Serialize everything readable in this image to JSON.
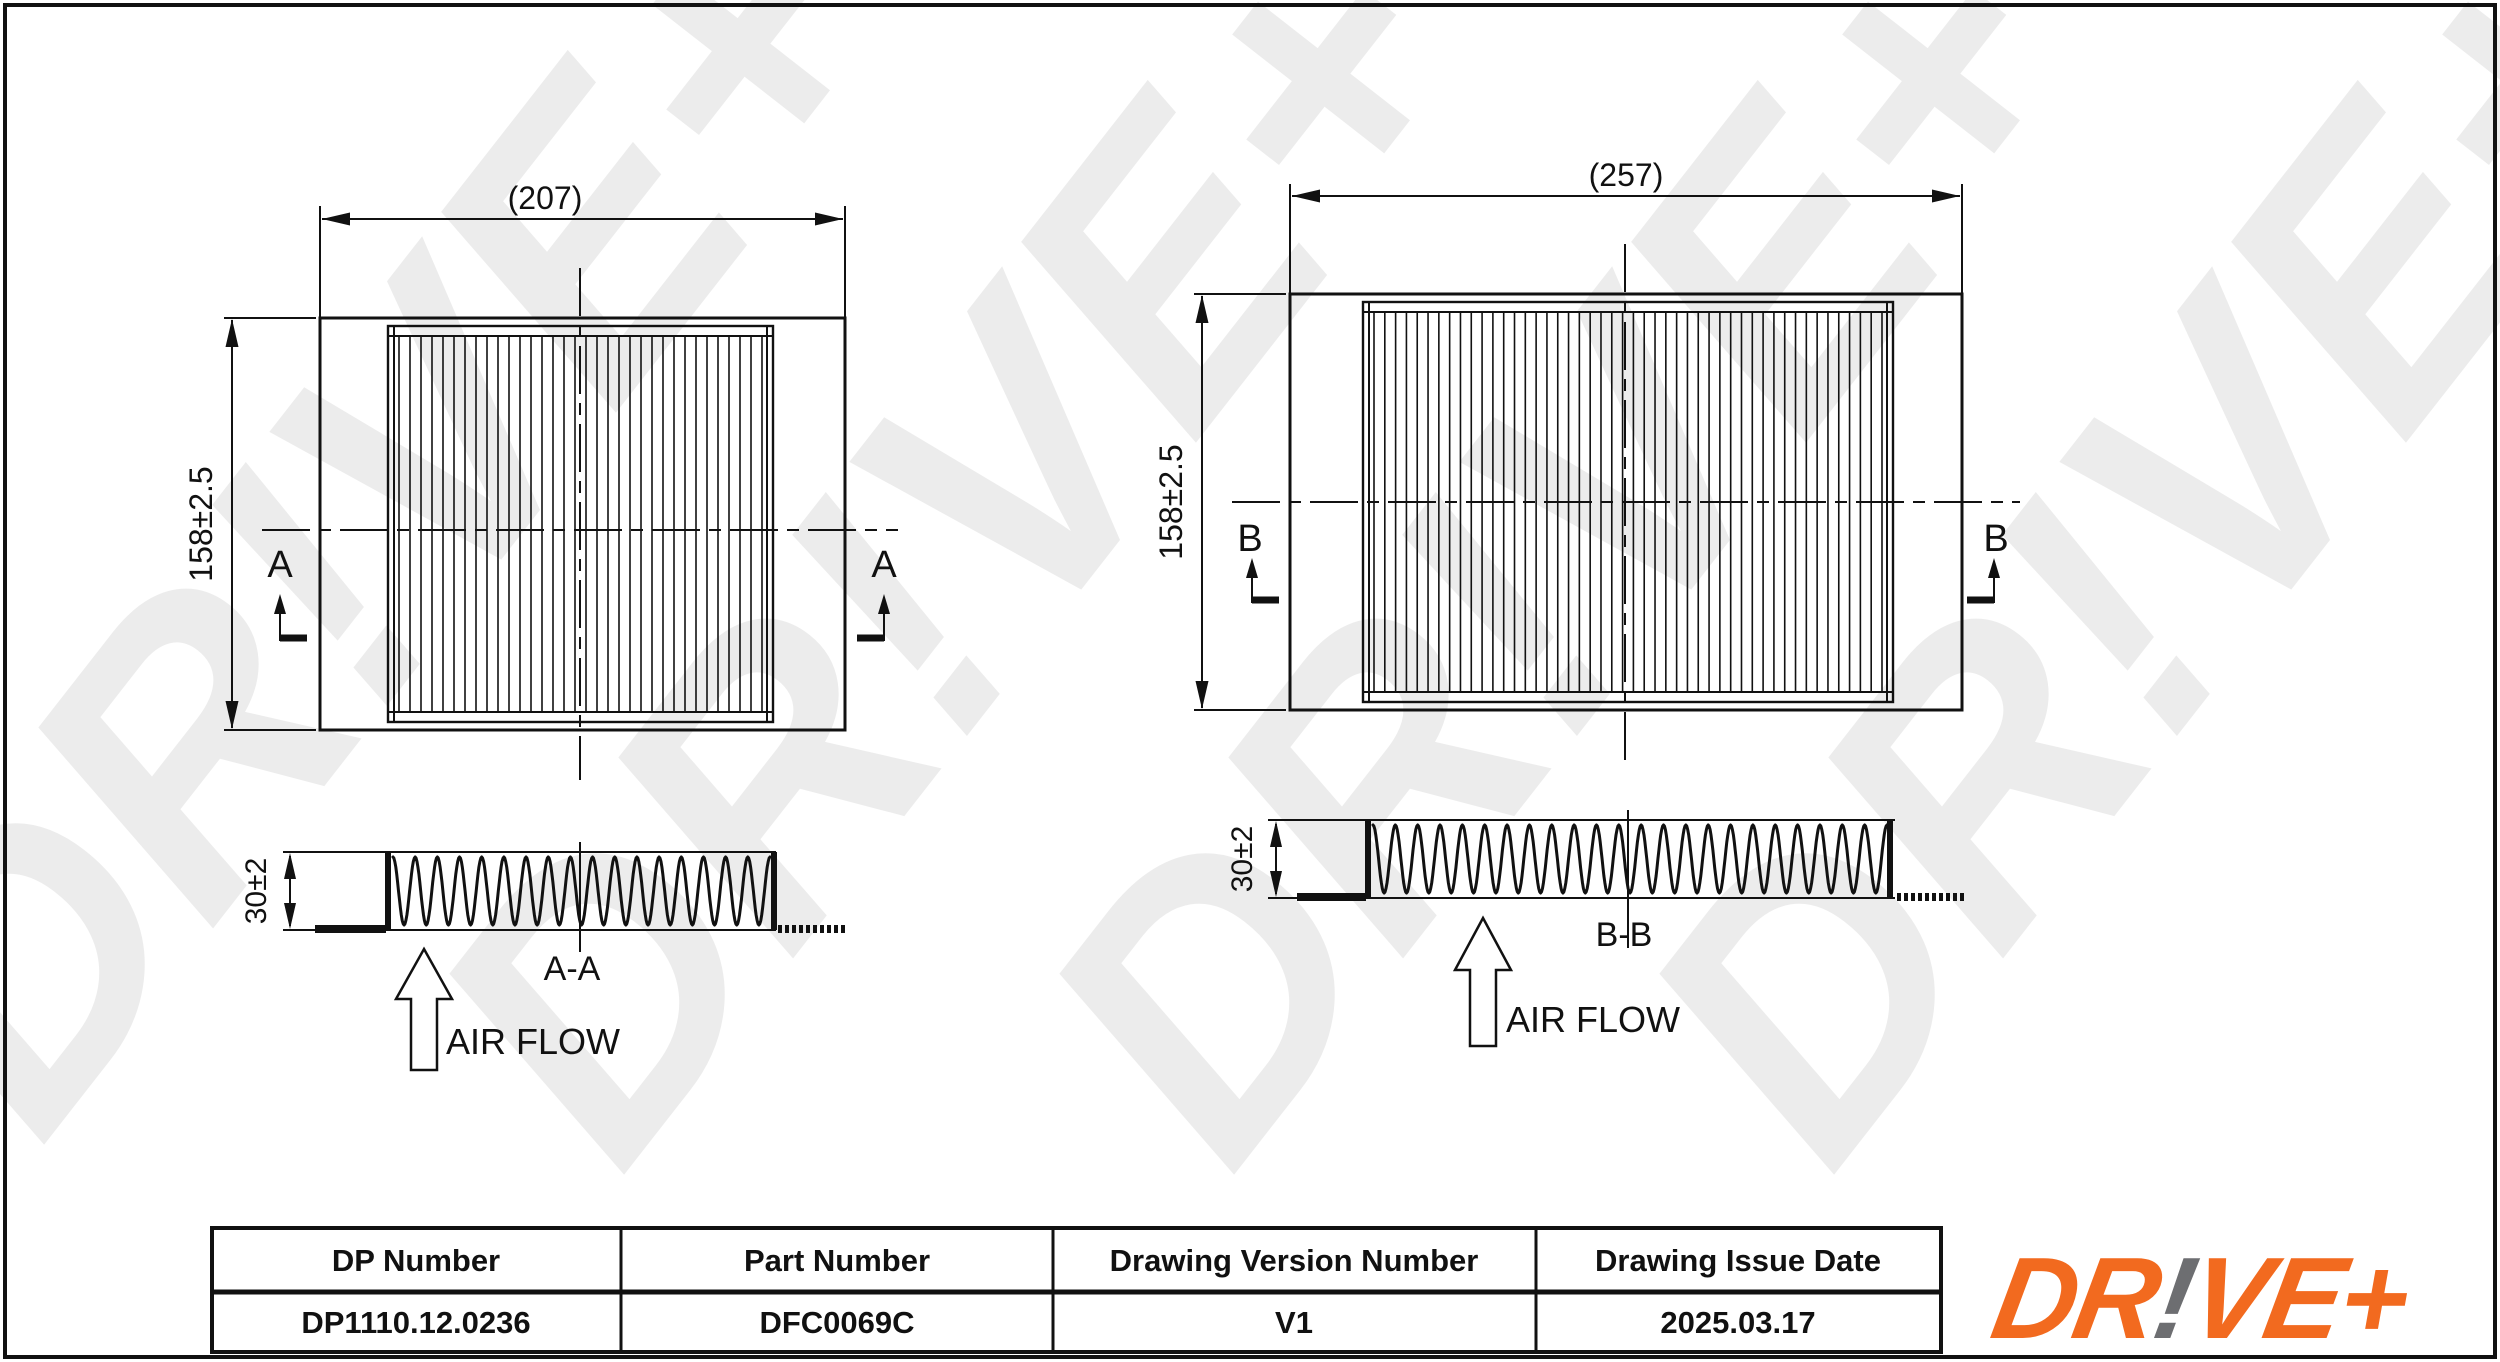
{
  "page": {
    "watermark": "DR!VE+"
  },
  "views": {
    "left_top": {
      "width_dim": "(207)",
      "height_dim": "158±2.5",
      "section_letter": "A"
    },
    "left_section": {
      "thickness_dim": "30±2",
      "label": "A-A",
      "airflow_label": "AIR FLOW"
    },
    "right_top": {
      "width_dim": "(257)",
      "height_dim": "158±2.5",
      "section_letter": "B"
    },
    "right_section": {
      "thickness_dim": "30±2",
      "label": "B-B",
      "airflow_label": "AIR FLOW"
    }
  },
  "title_block": {
    "headers": [
      "DP Number",
      "Part Number",
      "Drawing Version Number",
      "Drawing Issue Date"
    ],
    "values": [
      "DP1110.12.0236",
      "DFC0069C",
      "V1",
      "2025.03.17"
    ]
  },
  "logo": {
    "pre": "DR",
    "bang": "!",
    "post": "VE+"
  },
  "colors": {
    "line": "#111111",
    "logo_orange": "#F26A1F",
    "logo_grey": "#6D6E71",
    "watermark": "#E8E8E8"
  }
}
